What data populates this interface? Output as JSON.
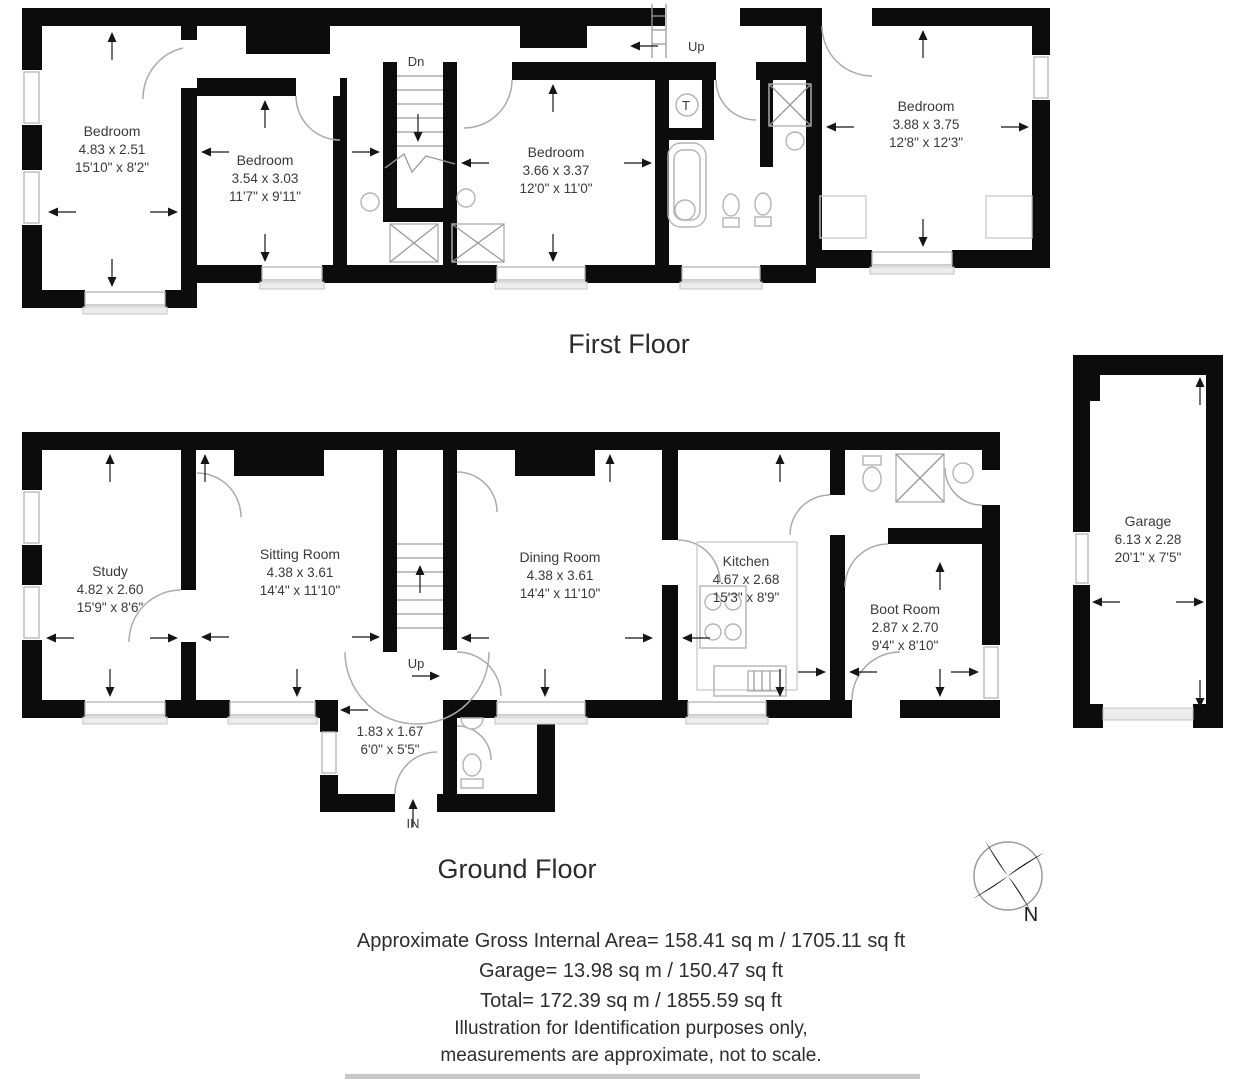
{
  "first_floor": {
    "title": "First Floor",
    "stairs_down_label": "Dn",
    "stairs_up_label": "Up",
    "tank_label": "T",
    "bedroom1": {
      "name": "Bedroom",
      "metric": "4.83 x 2.51",
      "imperial": "15'10\" x 8'2\""
    },
    "bedroom2": {
      "name": "Bedroom",
      "metric": "3.54 x 3.03",
      "imperial": "11'7\" x 9'11\""
    },
    "bedroom3": {
      "name": "Bedroom",
      "metric": "3.66 x 3.37",
      "imperial": "12'0\" x 11'0\""
    },
    "bedroom4": {
      "name": "Bedroom",
      "metric": "3.88 x 3.75",
      "imperial": "12'8\" x 12'3\""
    }
  },
  "ground_floor": {
    "title": "Ground Floor",
    "stairs_up_label": "Up",
    "entrance_in_label": "IN",
    "study": {
      "name": "Study",
      "metric": "4.82 x 2.60",
      "imperial": "15'9\" x 8'6\""
    },
    "sitting_room": {
      "name": "Sitting Room",
      "metric": "4.38 x 3.61",
      "imperial": "14'4\" x 11'10\""
    },
    "dining_room": {
      "name": "Dining Room",
      "metric": "4.38 x 3.61",
      "imperial": "14'4\" x 11'10\""
    },
    "kitchen": {
      "name": "Kitchen",
      "metric": "4.67 x 2.68",
      "imperial": "15'3\" x 8'9\""
    },
    "boot_room": {
      "name": "Boot Room",
      "metric": "2.87 x 2.70",
      "imperial": "9'4\" x 8'10\""
    },
    "entrance_hall": {
      "metric": "1.83 x 1.67",
      "imperial": "6'0\" x 5'5\""
    }
  },
  "garage": {
    "name": "Garage",
    "metric": "6.13 x 2.28",
    "imperial": "20'1\" x 7'5\""
  },
  "compass": {
    "north_label": "N"
  },
  "footer": {
    "area_line": "Approximate Gross Internal Area= 158.41 sq m / 1705.11 sq ft",
    "garage_line": "Garage= 13.98 sq m / 150.47 sq ft",
    "total_line": "Total= 172.39 sq m / 1855.59 sq ft",
    "disclaimer_line1": "Illustration for Identification purposes only,",
    "disclaimer_line2": "measurements are approximate, not to scale."
  },
  "colors": {
    "wall": "#0c0c0c",
    "fixture": "#b4b4b4",
    "text": "#3a3a3a"
  }
}
